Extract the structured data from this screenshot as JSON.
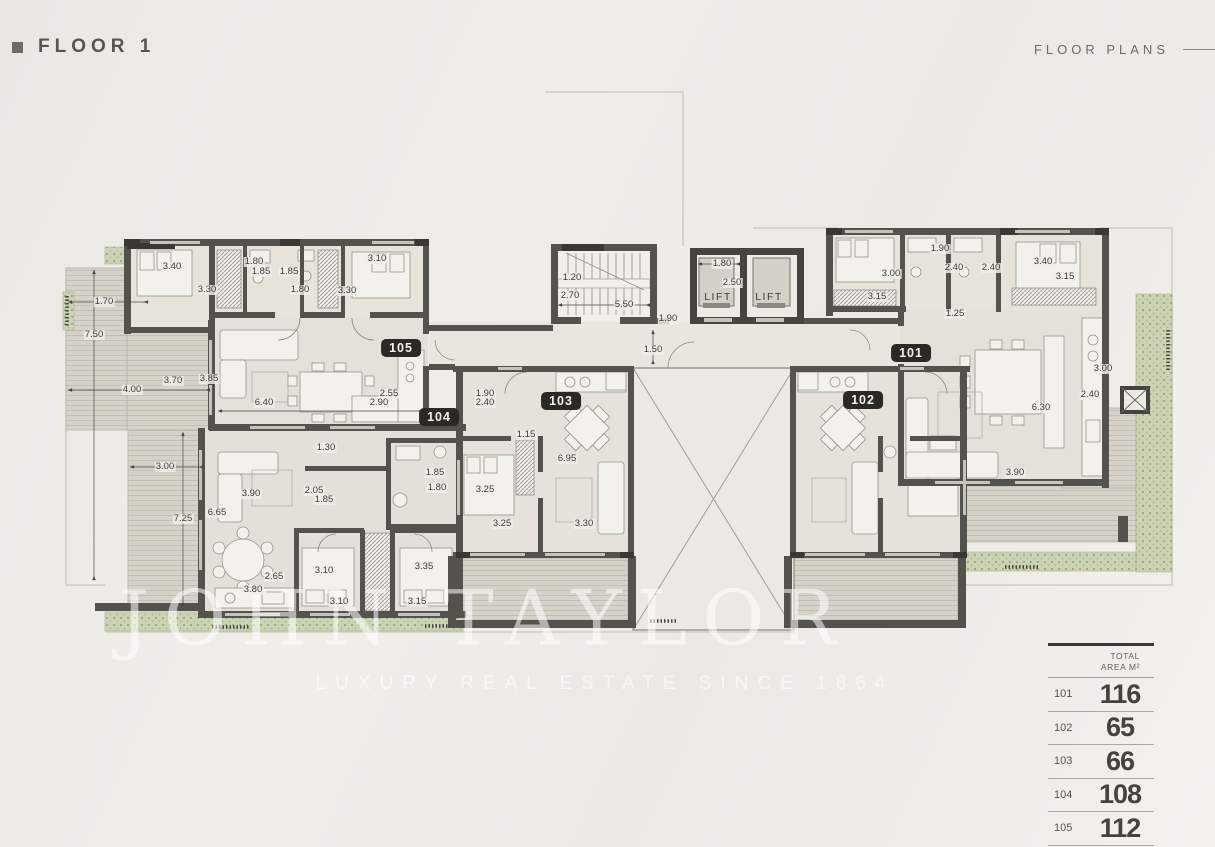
{
  "header": {
    "title": "FLOOR 1",
    "right_label": "FLOOR PLANS"
  },
  "watermark": {
    "line1": "JOHN TAYLOR",
    "line2": "LUXURY REAL ESTATE SINCE 1864"
  },
  "plan": {
    "units": [
      {
        "id": "101",
        "x": 911,
        "y": 353
      },
      {
        "id": "102",
        "x": 863,
        "y": 400
      },
      {
        "id": "103",
        "x": 561,
        "y": 401
      },
      {
        "id": "104",
        "x": 439,
        "y": 417
      },
      {
        "id": "105",
        "x": 401,
        "y": 348
      }
    ],
    "lifts": [
      {
        "label": "LIFT",
        "x": 718,
        "y": 297
      },
      {
        "label": "LIFT",
        "x": 769,
        "y": 297
      }
    ],
    "dimensions": [
      {
        "t": "3.40",
        "x": 172,
        "y": 267
      },
      {
        "t": "1.80",
        "x": 254,
        "y": 262
      },
      {
        "t": "1.85",
        "x": 261,
        "y": 272
      },
      {
        "t": "1.85",
        "x": 289,
        "y": 272
      },
      {
        "t": "3.10",
        "x": 377,
        "y": 259
      },
      {
        "t": "1.70",
        "x": 104,
        "y": 302
      },
      {
        "t": "3.30",
        "x": 207,
        "y": 290
      },
      {
        "t": "1.80",
        "x": 300,
        "y": 290
      },
      {
        "t": "3.30",
        "x": 347,
        "y": 291
      },
      {
        "t": "7.50",
        "x": 94,
        "y": 335
      },
      {
        "t": "3.85",
        "x": 209,
        "y": 379
      },
      {
        "t": "3.70",
        "x": 173,
        "y": 381
      },
      {
        "t": "4.00",
        "x": 132,
        "y": 390
      },
      {
        "t": "6.40",
        "x": 264,
        "y": 403
      },
      {
        "t": "2.55",
        "x": 389,
        "y": 394
      },
      {
        "t": "2.90",
        "x": 379,
        "y": 403
      },
      {
        "t": "1.20",
        "x": 572,
        "y": 278
      },
      {
        "t": "2.70",
        "x": 570,
        "y": 296
      },
      {
        "t": "5.50",
        "x": 624,
        "y": 305
      },
      {
        "t": "1.90",
        "x": 668,
        "y": 319
      },
      {
        "t": "1.50",
        "x": 653,
        "y": 350
      },
      {
        "t": "1.80",
        "x": 722,
        "y": 264
      },
      {
        "t": "2.50",
        "x": 732,
        "y": 283
      },
      {
        "t": "1.90",
        "x": 940,
        "y": 249
      },
      {
        "t": "3.00",
        "x": 891,
        "y": 274
      },
      {
        "t": "2.40",
        "x": 954,
        "y": 268
      },
      {
        "t": "2.40",
        "x": 991,
        "y": 268
      },
      {
        "t": "3.40",
        "x": 1043,
        "y": 262
      },
      {
        "t": "3.15",
        "x": 1065,
        "y": 277
      },
      {
        "t": "3.15",
        "x": 877,
        "y": 297
      },
      {
        "t": "1.25",
        "x": 955,
        "y": 314
      },
      {
        "t": "3.00",
        "x": 1103,
        "y": 369
      },
      {
        "t": "2.40",
        "x": 1090,
        "y": 395
      },
      {
        "t": "6.30",
        "x": 1041,
        "y": 408
      },
      {
        "t": "3.90",
        "x": 1015,
        "y": 473
      },
      {
        "t": "1.90",
        "x": 485,
        "y": 394
      },
      {
        "t": "2.40",
        "x": 485,
        "y": 403
      },
      {
        "t": "1.15",
        "x": 526,
        "y": 435
      },
      {
        "t": "6.95",
        "x": 567,
        "y": 459
      },
      {
        "t": "3.25",
        "x": 485,
        "y": 490
      },
      {
        "t": "3.25",
        "x": 502,
        "y": 524
      },
      {
        "t": "3.30",
        "x": 584,
        "y": 524
      },
      {
        "t": "1.30",
        "x": 326,
        "y": 448
      },
      {
        "t": "3.00",
        "x": 165,
        "y": 467
      },
      {
        "t": "3.90",
        "x": 251,
        "y": 494
      },
      {
        "t": "2.05",
        "x": 314,
        "y": 491
      },
      {
        "t": "1.85",
        "x": 324,
        "y": 500
      },
      {
        "t": "7.25",
        "x": 183,
        "y": 519
      },
      {
        "t": "6.65",
        "x": 217,
        "y": 513
      },
      {
        "t": "1.85",
        "x": 435,
        "y": 473
      },
      {
        "t": "1.80",
        "x": 437,
        "y": 488
      },
      {
        "t": "2.65",
        "x": 274,
        "y": 577
      },
      {
        "t": "3.10",
        "x": 324,
        "y": 571
      },
      {
        "t": "3.35",
        "x": 424,
        "y": 567
      },
      {
        "t": "3.80",
        "x": 253,
        "y": 590
      },
      {
        "t": "3.10",
        "x": 339,
        "y": 602
      },
      {
        "t": "3.15",
        "x": 417,
        "y": 602
      }
    ]
  },
  "area_table": {
    "header_line1": "TOTAL",
    "header_line2": "AREA M²",
    "rows": [
      {
        "unit": "101",
        "area": "116"
      },
      {
        "unit": "102",
        "area": "65"
      },
      {
        "unit": "103",
        "area": "66"
      },
      {
        "unit": "104",
        "area": "108"
      },
      {
        "unit": "105",
        "area": "112"
      }
    ]
  },
  "colors": {
    "wall": "#54524c",
    "wall_dark": "#393833",
    "deck": "#d6d2c9",
    "planter": "#ccd3b4",
    "badge_bg": "#2a2925",
    "background": "#efede9"
  }
}
